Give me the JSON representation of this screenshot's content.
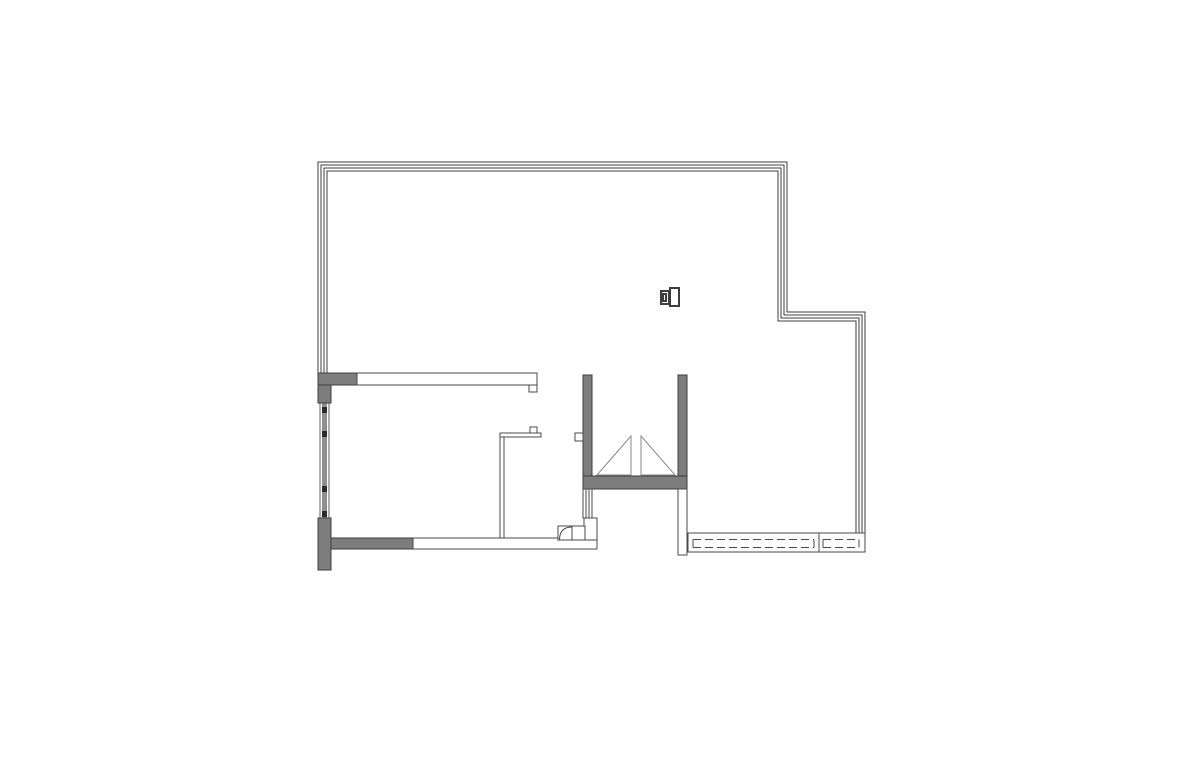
{
  "canvas": {
    "width": 1200,
    "height": 776,
    "background": "#ffffff"
  },
  "palette": {
    "boundary_line": "#3f3f3f",
    "outline_line": "#4a4a4a",
    "thin_line": "#5f5f5f",
    "wall_fill": "#7d7d7d",
    "wall_border": "#3d3d3d",
    "window_band": "#8f8f8f",
    "window_marker": "#2b2b2b",
    "triangle_line": "#8a8a8a",
    "white": "#ffffff"
  },
  "plan": {
    "boundary": {
      "name": "glazed-perimeter-wall",
      "polylines": [
        [
          [
            318,
            373
          ],
          [
            318,
            162
          ],
          [
            787,
            162
          ],
          [
            787,
            312
          ],
          [
            865,
            312
          ],
          [
            865,
            533
          ]
        ],
        [
          [
            321,
            373
          ],
          [
            321,
            165
          ],
          [
            784,
            165
          ],
          [
            784,
            315
          ],
          [
            862,
            315
          ],
          [
            862,
            533
          ]
        ],
        [
          [
            324,
            373
          ],
          [
            324,
            168
          ],
          [
            781,
            168
          ],
          [
            781,
            318
          ],
          [
            859,
            318
          ],
          [
            859,
            533
          ]
        ],
        [
          [
            327,
            373
          ],
          [
            327,
            171
          ],
          [
            778,
            171
          ],
          [
            778,
            321
          ],
          [
            856,
            321
          ],
          [
            856,
            533
          ]
        ]
      ]
    },
    "filled_walls": [
      {
        "name": "top-left-wall-horizontal",
        "x": 318,
        "y": 373,
        "w": 40,
        "h": 12
      },
      {
        "name": "top-left-wall-vertical",
        "x": 318,
        "y": 385,
        "w": 13,
        "h": 18
      },
      {
        "name": "bottom-left-wall-vertical",
        "x": 318,
        "y": 518,
        "w": 13,
        "h": 52
      },
      {
        "name": "bottom-left-wall-horizontal",
        "x": 331,
        "y": 538,
        "w": 82,
        "h": 11
      },
      {
        "name": "shaft-wall-left",
        "x": 583,
        "y": 375,
        "w": 9,
        "h": 114
      },
      {
        "name": "shaft-wall-right",
        "x": 678,
        "y": 375,
        "w": 9,
        "h": 114
      },
      {
        "name": "shaft-wall-bottom",
        "x": 583,
        "y": 476,
        "w": 104,
        "h": 13
      }
    ],
    "outline_walls": [
      {
        "name": "top-partition-wall",
        "x": 357,
        "y": 373,
        "w": 180,
        "h": 12
      },
      {
        "name": "top-partition-end-tab",
        "x": 529,
        "y": 385,
        "w": 8,
        "h": 7
      },
      {
        "name": "mid-partition-horizontal",
        "x": 500,
        "y": 433,
        "w": 41,
        "h": 4
      },
      {
        "name": "mid-partition-top-tab",
        "x": 530,
        "y": 427,
        "w": 7,
        "h": 6
      },
      {
        "name": "mid-partition-vertical",
        "x": 500,
        "y": 437,
        "w": 4,
        "h": 103
      },
      {
        "name": "bottom-partition-wall",
        "x": 413,
        "y": 538,
        "w": 184,
        "h": 11
      },
      {
        "name": "shaft-left-fixture",
        "x": 575,
        "y": 433,
        "w": 8,
        "h": 8
      },
      {
        "name": "below-shaft-wall",
        "x": 584,
        "y": 518,
        "w": 13,
        "h": 22
      },
      {
        "name": "shaft-right-lower-wall",
        "x": 678,
        "y": 489,
        "w": 9,
        "h": 66
      },
      {
        "name": "door-box",
        "x": 558,
        "y": 526,
        "w": 27,
        "h": 14
      }
    ],
    "door": {
      "divider": [
        572,
        526,
        572,
        540
      ],
      "arc_path": "M 559.5 540 Q 559.5 527 572 527"
    },
    "shaft_window": {
      "name": "shaft-lower-window",
      "rect": {
        "x": 583,
        "y": 489,
        "w": 9,
        "h": 29
      },
      "inner_lines_x": [
        586,
        589
      ]
    },
    "left_window": {
      "name": "left-facade-window",
      "y1": 403,
      "y2": 518,
      "rail_left_x": 320,
      "rail_right_x": 329,
      "band": {
        "x": 322,
        "y": 403,
        "w": 5,
        "h": 115
      },
      "markers_y": [
        407,
        431,
        486,
        511
      ],
      "marker_w": 5,
      "marker_h": 6,
      "marker_x": 322
    },
    "rails": {
      "name": "balcony-railing",
      "inner_y1": 539.5,
      "inner_y2": 547.5,
      "dash": "8 4",
      "boxes": [
        {
          "x": 688,
          "y": 533,
          "w": 131,
          "h": 19,
          "inner_x1": 693,
          "inner_x2": 814
        },
        {
          "x": 819,
          "y": 533,
          "w": 46,
          "h": 19,
          "inner_x1": 823,
          "inner_x2": 859
        }
      ]
    },
    "shaft_triangles": [
      [
        597,
        475,
        631,
        436,
        631,
        475
      ],
      [
        641,
        436,
        675,
        475,
        641,
        475
      ]
    ],
    "fixture_symbol": {
      "name": "wall-fixture-symbol",
      "rects": [
        {
          "x": 670,
          "y": 288,
          "w": 9,
          "h": 18
        },
        {
          "x": 661,
          "y": 291,
          "w": 8,
          "h": 13
        },
        {
          "x": 663,
          "y": 294,
          "w": 3,
          "h": 7
        }
      ]
    }
  }
}
